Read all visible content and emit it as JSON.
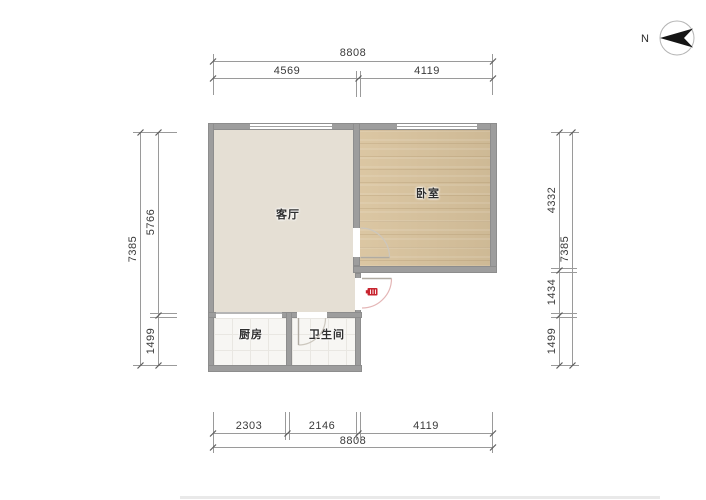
{
  "compass": {
    "north_label": "N"
  },
  "rooms": {
    "living_room": {
      "label": "客厅"
    },
    "bedroom": {
      "label": "卧室"
    },
    "kitchen": {
      "label": "厨房"
    },
    "bathroom": {
      "label": "卫生间"
    }
  },
  "dimensions": {
    "top": {
      "total": "8808",
      "segments": [
        "4569",
        "4119"
      ]
    },
    "bottom": {
      "total": "8808",
      "segments": [
        "2303",
        "2146",
        "4119"
      ]
    },
    "left": {
      "total": "7385",
      "segments": [
        "5766",
        "1499"
      ]
    },
    "right": {
      "total": "7385",
      "segments": [
        "4332",
        "1434",
        "1499"
      ]
    }
  },
  "colors": {
    "wall": "#9d9d9d",
    "living_floor": "#e5dfd4",
    "bedroom_floor": "#d9c39d",
    "wet_room_floor": "#f7f6f3",
    "entrance_icon": "#c8242f"
  }
}
